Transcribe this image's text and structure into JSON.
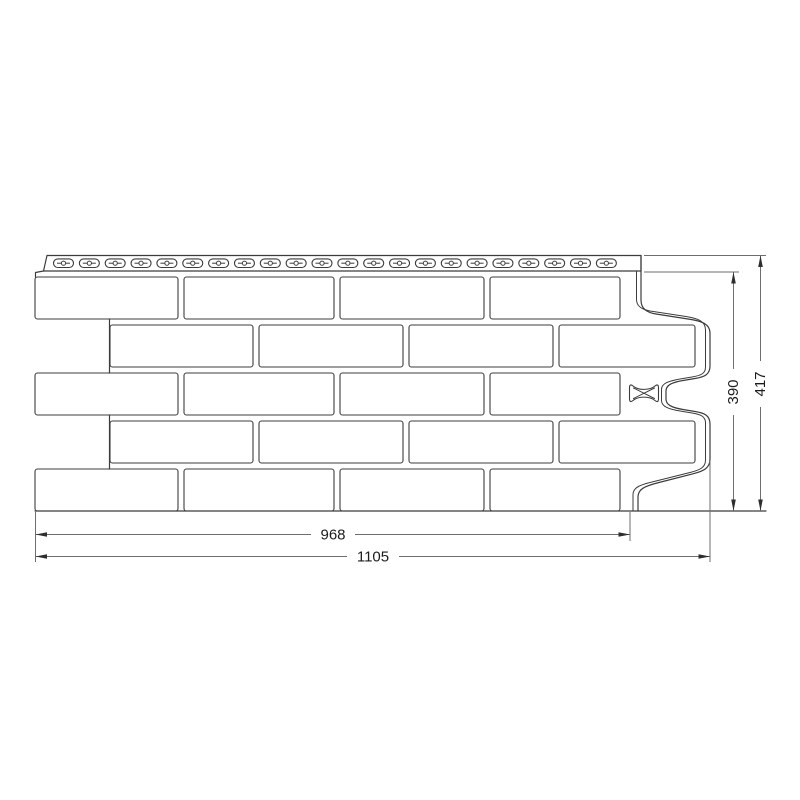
{
  "drawing": {
    "title": "facade-panel-brick-technical-drawing",
    "dimensions": {
      "panel_width_label": "968",
      "total_width_label": "1105",
      "panel_height_label": "390",
      "total_height_label": "417"
    },
    "nail_strip": {
      "slot_count": 22
    },
    "brick_grid": {
      "rows": 5,
      "bricks_per_row": 4
    },
    "logo": "x-bowtie-logo-mark",
    "colors": {
      "background": "#ffffff",
      "panel_outline": "#3c3c3c",
      "dimension_line": "#6e6e6e",
      "dimension_text": "#1c1c1c"
    }
  }
}
